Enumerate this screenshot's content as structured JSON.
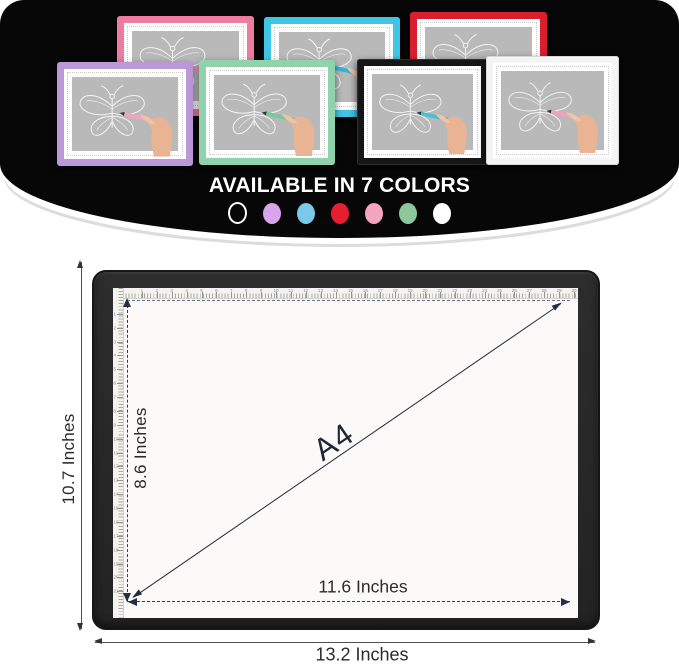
{
  "hero": {
    "title": "AVAILABLE IN 7 COLORS",
    "background_color": "#070707",
    "pads": [
      {
        "name": "pink",
        "frame_color": "#ee7ba0",
        "pen_color": "#f191b4"
      },
      {
        "name": "cyan",
        "frame_color": "#41c5e4",
        "pen_color": "#2fb6d6"
      },
      {
        "name": "red",
        "frame_color": "#d91f2d",
        "pen_color": "#d92231"
      },
      {
        "name": "purple",
        "frame_color": "#bb98d8",
        "pen_color": "#f3a3c2"
      },
      {
        "name": "green",
        "frame_color": "#8fd2ab",
        "pen_color": "#74ca9a"
      },
      {
        "name": "black",
        "frame_color": "#161616",
        "pen_color": "#3fc3d8"
      },
      {
        "name": "white",
        "frame_color": "#f4f4f4",
        "pen_color": "#f2a0bd"
      }
    ],
    "swatches": [
      {
        "name": "black",
        "fill": "none",
        "ring": "#ffffff"
      },
      {
        "name": "purple",
        "fill": "#d9a4ea"
      },
      {
        "name": "blue",
        "fill": "#7ac9e8"
      },
      {
        "name": "red",
        "fill": "#e61e31"
      },
      {
        "name": "pink",
        "fill": "#f6a5c1"
      },
      {
        "name": "green",
        "fill": "#8ec79d"
      },
      {
        "name": "white",
        "fill": "#ffffff"
      }
    ]
  },
  "diagram": {
    "size_label": "A4",
    "outer_height_label": "10.7 Inches",
    "outer_width_label": "13.2 Inches",
    "inner_height_label": "8.6 Inches",
    "inner_width_label": "11.6 Inches",
    "ruler": {
      "top_marks": 30,
      "left_marks": 21
    },
    "dash_color": "#2e3b55",
    "line_color": "#4f4f4f"
  }
}
